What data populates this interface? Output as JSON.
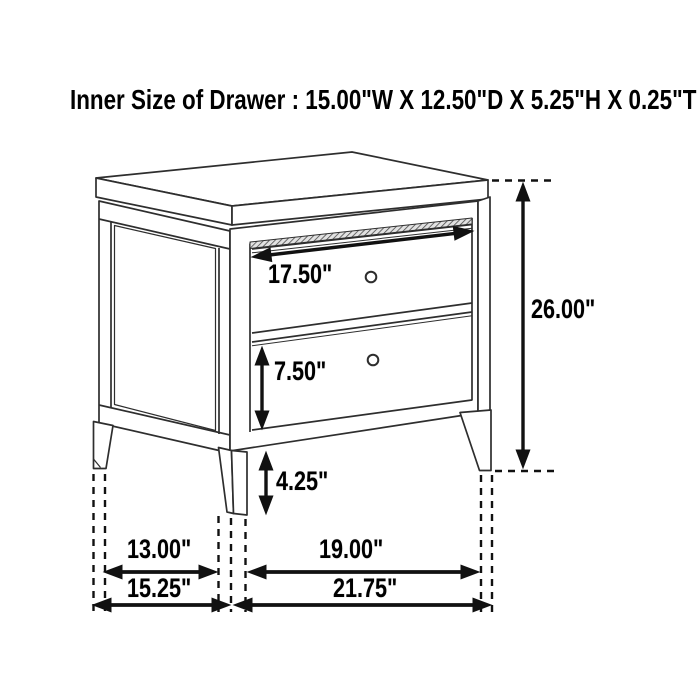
{
  "title": "Inner Size of Drawer : 15.00\"W X 12.50\"D X 5.25\"H X 0.25\"T",
  "dimension_labels": {
    "drawer_front_width": "17.50\"",
    "bottom_drawer_height": "7.50\"",
    "leg_height": "4.25\"",
    "overall_height": "26.00\"",
    "inner_leg_depth": "13.00\"",
    "inner_leg_width": "19.00\"",
    "overall_depth": "15.25\"",
    "overall_width": "21.75\""
  },
  "colors": {
    "background": "#ffffff",
    "line_art": "#2e2e2e",
    "dimension_ink": "#111111",
    "text": "#000000"
  }
}
